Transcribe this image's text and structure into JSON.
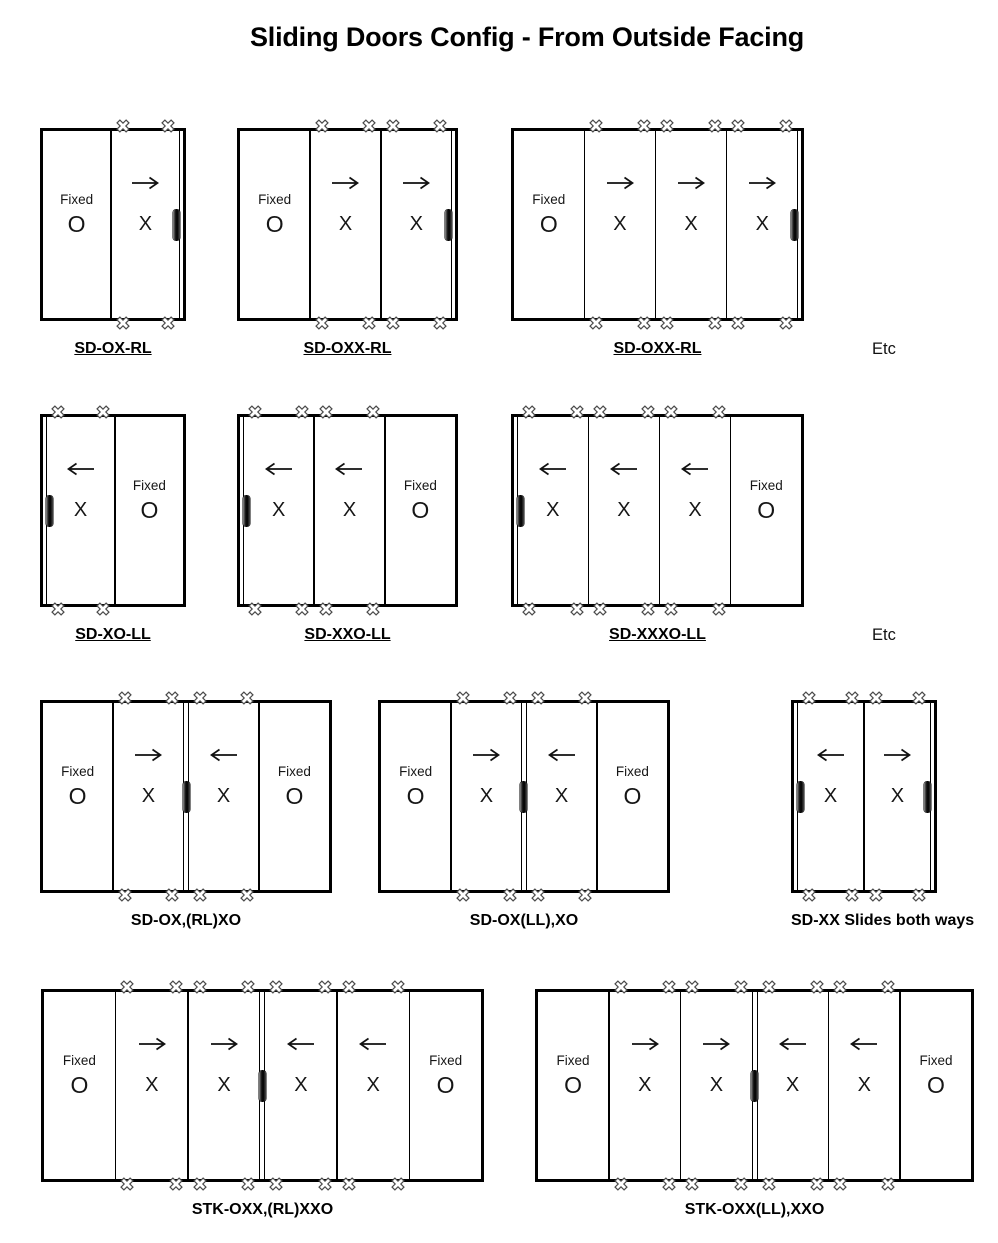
{
  "title": "Sliding Doors Config - From Outside Facing",
  "colors": {
    "line": "#000000",
    "text": "#161616",
    "background": "#ffffff",
    "handle": "#111111"
  },
  "icons": {
    "cross": "cross-mark-icon",
    "arrow_left": "arrow-left-icon",
    "arrow_right": "arrow-right-icon",
    "handle": "door-handle"
  },
  "rows": [
    {
      "etc_label": "Etc",
      "diagrams": [
        {
          "label": "SD-OX-RL",
          "underlined": true,
          "tracks": [
            "right"
          ],
          "double_divider_after": null,
          "panels": [
            {
              "type": "fixed",
              "top_label": "Fixed",
              "letter": "O",
              "arrow": null,
              "handle": null
            },
            {
              "type": "slider",
              "letter": "X",
              "arrow": "right",
              "handle": "right"
            }
          ]
        },
        {
          "label": "SD-OXX-RL",
          "underlined": true,
          "tracks": [
            "right"
          ],
          "double_divider_after": null,
          "panels": [
            {
              "type": "fixed",
              "top_label": "Fixed",
              "letter": "O",
              "arrow": null,
              "handle": null
            },
            {
              "type": "slider",
              "letter": "X",
              "arrow": "right",
              "handle": null
            },
            {
              "type": "slider",
              "letter": "X",
              "arrow": "right",
              "handle": "right"
            }
          ]
        },
        {
          "label": "SD-OXX-RL",
          "underlined": true,
          "tracks": [
            "right"
          ],
          "double_divider_after": null,
          "panels": [
            {
              "type": "fixed",
              "top_label": "Fixed",
              "letter": "O",
              "arrow": null,
              "handle": null
            },
            {
              "type": "slider",
              "letter": "X",
              "arrow": "right",
              "handle": null
            },
            {
              "type": "slider",
              "letter": "X",
              "arrow": "right",
              "handle": null
            },
            {
              "type": "slider",
              "letter": "X",
              "arrow": "right",
              "handle": "right"
            }
          ]
        }
      ]
    },
    {
      "etc_label": "Etc",
      "diagrams": [
        {
          "label": "SD-XO-LL",
          "underlined": true,
          "tracks": [
            "left"
          ],
          "double_divider_after": null,
          "panels": [
            {
              "type": "slider",
              "letter": "X",
              "arrow": "left",
              "handle": "left"
            },
            {
              "type": "fixed",
              "top_label": "Fixed",
              "letter": "O",
              "arrow": null,
              "handle": null
            }
          ]
        },
        {
          "label": "SD-XXO-LL",
          "underlined": true,
          "tracks": [
            "left"
          ],
          "double_divider_after": null,
          "panels": [
            {
              "type": "slider",
              "letter": "X",
              "arrow": "left",
              "handle": "left"
            },
            {
              "type": "slider",
              "letter": "X",
              "arrow": "left",
              "handle": null
            },
            {
              "type": "fixed",
              "top_label": "Fixed",
              "letter": "O",
              "arrow": null,
              "handle": null
            }
          ]
        },
        {
          "label": "SD-XXXO-LL",
          "underlined": true,
          "tracks": [
            "left"
          ],
          "double_divider_after": null,
          "panels": [
            {
              "type": "slider",
              "letter": "X",
              "arrow": "left",
              "handle": "left"
            },
            {
              "type": "slider",
              "letter": "X",
              "arrow": "left",
              "handle": null
            },
            {
              "type": "slider",
              "letter": "X",
              "arrow": "left",
              "handle": null
            },
            {
              "type": "fixed",
              "top_label": "Fixed",
              "letter": "O",
              "arrow": null,
              "handle": null
            }
          ]
        }
      ]
    },
    {
      "diagrams": [
        {
          "label": "SD-OX,(RL)XO",
          "underlined": false,
          "tracks": [],
          "double_divider_after": 1,
          "panels": [
            {
              "type": "fixed",
              "top_label": "Fixed",
              "letter": "O",
              "arrow": null,
              "handle": null
            },
            {
              "type": "slider",
              "letter": "X",
              "arrow": "right",
              "handle": null
            },
            {
              "type": "slider",
              "letter": "X",
              "arrow": "left",
              "handle": "left"
            },
            {
              "type": "fixed",
              "top_label": "Fixed",
              "letter": "O",
              "arrow": null,
              "handle": null
            }
          ]
        },
        {
          "label": "SD-OX(LL),XO",
          "underlined": false,
          "tracks": [],
          "double_divider_after": 1,
          "panels": [
            {
              "type": "fixed",
              "top_label": "Fixed",
              "letter": "O",
              "arrow": null,
              "handle": null
            },
            {
              "type": "slider",
              "letter": "X",
              "arrow": "right",
              "handle": "right"
            },
            {
              "type": "slider",
              "letter": "X",
              "arrow": "left",
              "handle": null
            },
            {
              "type": "fixed",
              "top_label": "Fixed",
              "letter": "O",
              "arrow": null,
              "handle": null
            }
          ]
        },
        {
          "label": "SD-XX Slides both ways",
          "underlined": false,
          "tracks": [
            "left",
            "right"
          ],
          "double_divider_after": null,
          "panels": [
            {
              "type": "slider",
              "letter": "X",
              "arrow": "left",
              "handle": "left"
            },
            {
              "type": "slider",
              "letter": "X",
              "arrow": "right",
              "handle": "right"
            }
          ]
        }
      ]
    },
    {
      "diagrams": [
        {
          "label": "STK-OXX,(RL)XXO",
          "underlined": false,
          "tracks": [],
          "double_divider_after": 2,
          "panels": [
            {
              "type": "fixed",
              "top_label": "Fixed",
              "letter": "O",
              "arrow": null,
              "handle": null
            },
            {
              "type": "slider",
              "letter": "X",
              "arrow": "right",
              "handle": null
            },
            {
              "type": "slider",
              "letter": "X",
              "arrow": "right",
              "handle": null
            },
            {
              "type": "slider",
              "letter": "X",
              "arrow": "left",
              "handle": "left"
            },
            {
              "type": "slider",
              "letter": "X",
              "arrow": "left",
              "handle": null
            },
            {
              "type": "fixed",
              "top_label": "Fixed",
              "letter": "O",
              "arrow": null,
              "handle": null
            }
          ]
        },
        {
          "label": "STK-OXX(LL),XXO",
          "underlined": false,
          "tracks": [],
          "double_divider_after": 2,
          "panels": [
            {
              "type": "fixed",
              "top_label": "Fixed",
              "letter": "O",
              "arrow": null,
              "handle": null
            },
            {
              "type": "slider",
              "letter": "X",
              "arrow": "right",
              "handle": null
            },
            {
              "type": "slider",
              "letter": "X",
              "arrow": "right",
              "handle": "right"
            },
            {
              "type": "slider",
              "letter": "X",
              "arrow": "left",
              "handle": null
            },
            {
              "type": "slider",
              "letter": "X",
              "arrow": "left",
              "handle": null
            },
            {
              "type": "fixed",
              "top_label": "Fixed",
              "letter": "O",
              "arrow": null,
              "handle": null
            }
          ]
        }
      ]
    }
  ]
}
